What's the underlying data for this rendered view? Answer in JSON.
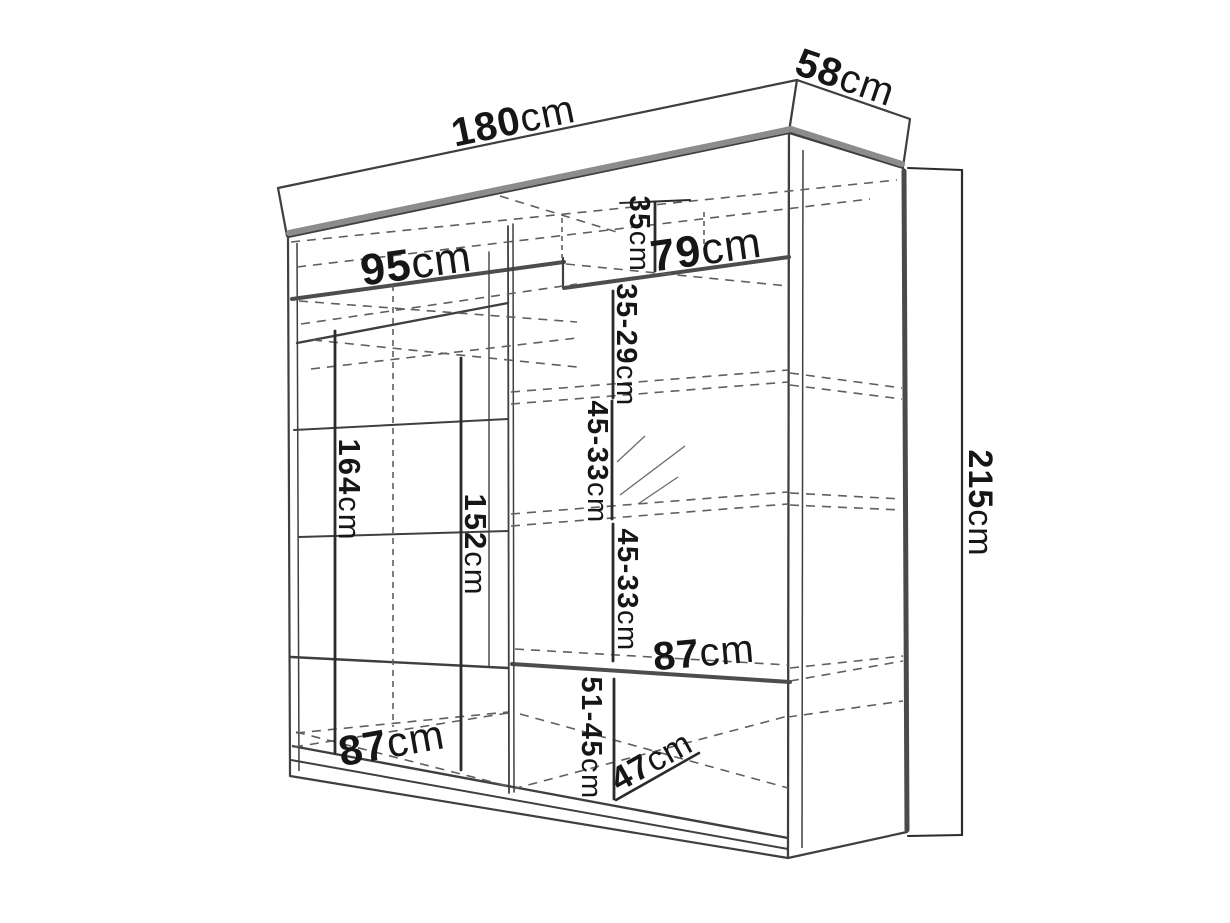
{
  "diagram": {
    "type": "furniture-technical-drawing",
    "unit": "cm",
    "colors": {
      "background": "#ffffff",
      "outline": "#3f3f3f",
      "thick_edge": "#8c8c8c",
      "shelf_thick": "#4d4d4d",
      "dimension_line": "#2b2b2b",
      "dashed_line": "#5f5f5f",
      "text": "#161616"
    },
    "labels": {
      "width": {
        "value": "180",
        "unit": "cm"
      },
      "depth": {
        "value": "58",
        "unit": "cm"
      },
      "height": {
        "value": "215",
        "unit": "cm"
      },
      "top_left_width": {
        "value": "95",
        "unit": "cm"
      },
      "top_right_width": {
        "value": "79",
        "unit": "cm"
      },
      "top_right_height": {
        "value": "35",
        "unit": "cm"
      },
      "upper_shelf_gap": {
        "value": "35-29",
        "unit": "cm"
      },
      "middle_shelf_gap": {
        "value": "45-33",
        "unit": "cm"
      },
      "lower_shelf_gap": {
        "value": "45-33",
        "unit": "cm"
      },
      "right_shelf_width": {
        "value": "87",
        "unit": "cm"
      },
      "bottom_shelf_gap": {
        "value": "51-45",
        "unit": "cm"
      },
      "bottom_left_width": {
        "value": "87",
        "unit": "cm"
      },
      "bottom_depth": {
        "value": "47",
        "unit": "cm"
      },
      "hanging_height_left": {
        "value": "164",
        "unit": "cm"
      },
      "hanging_height_right": {
        "value": "152",
        "unit": "cm"
      }
    }
  }
}
